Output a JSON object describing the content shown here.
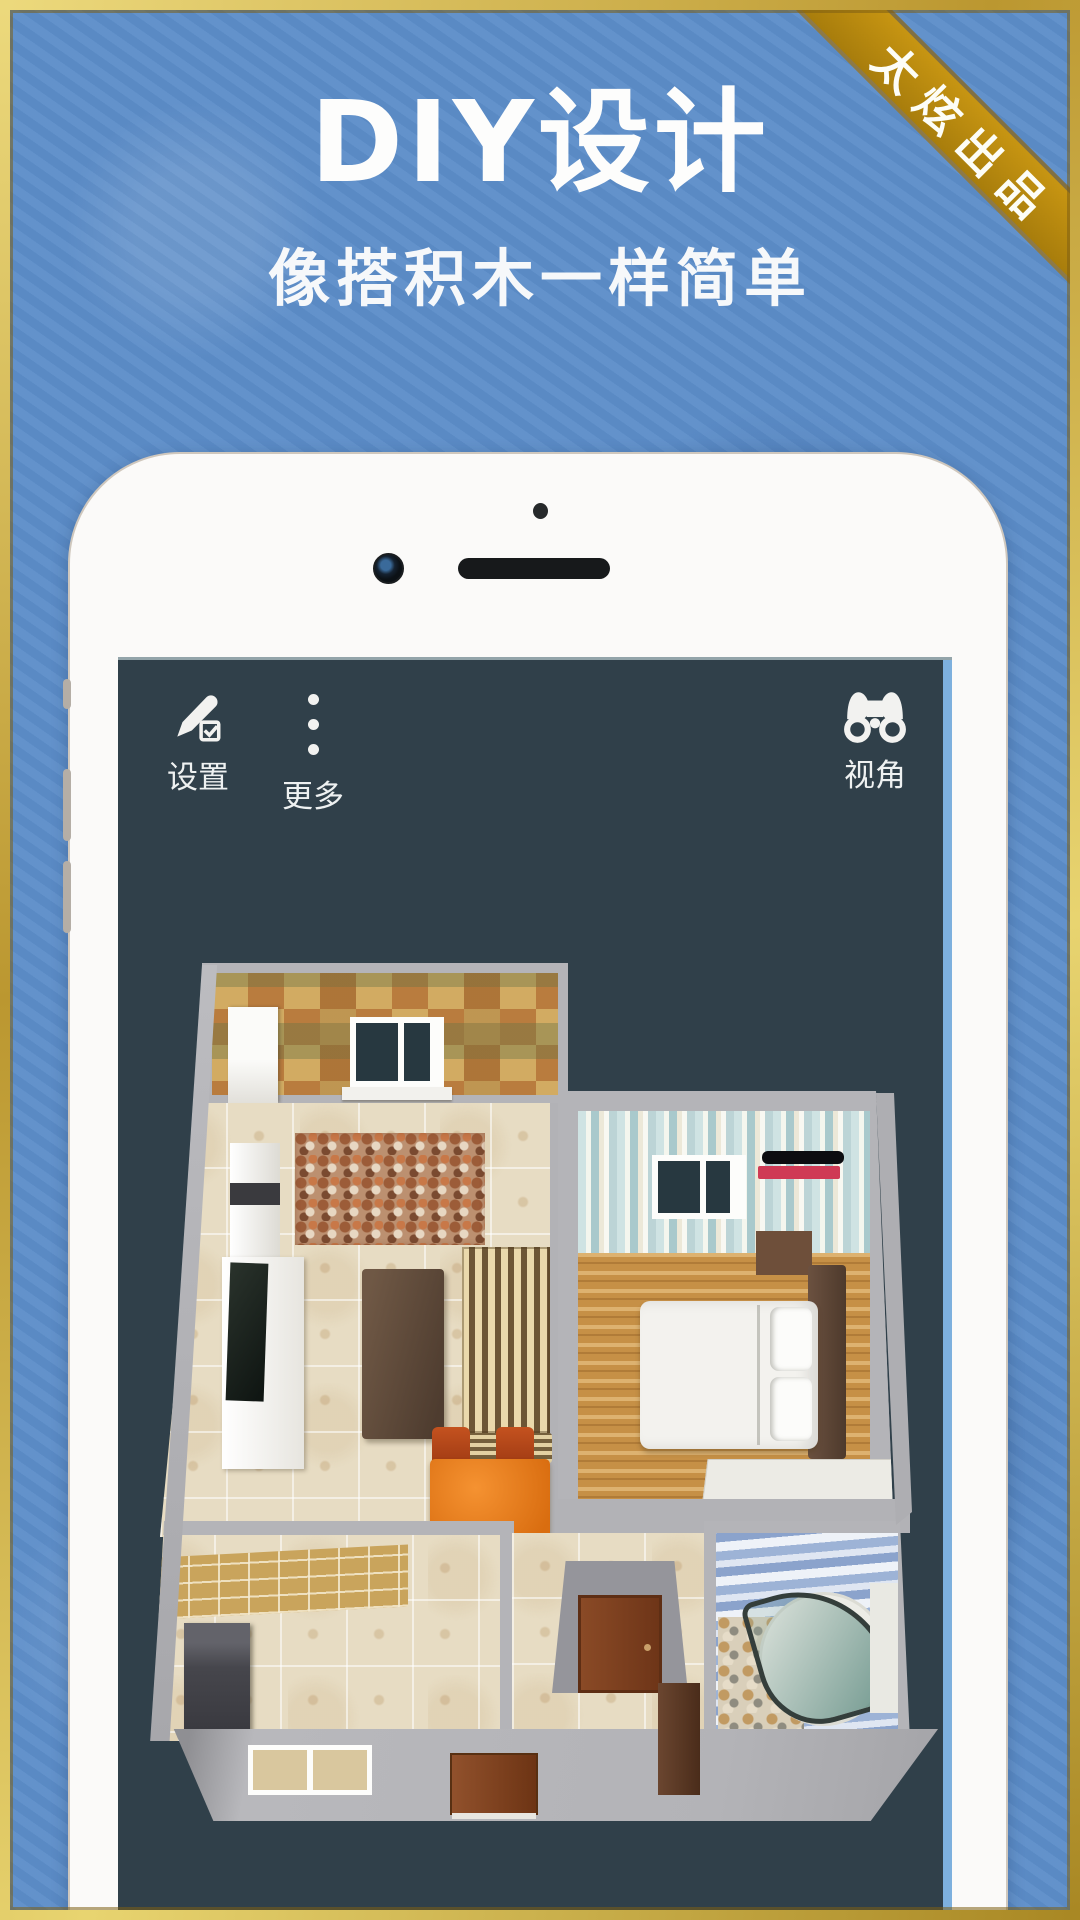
{
  "page": {
    "title": "DIY设计",
    "subtitle": "像搭积木一样简单",
    "ribbon": "太炫出品"
  },
  "toolbar": {
    "items": [
      {
        "id": "settings",
        "label": "设置",
        "icon": "pencil-check-icon"
      },
      {
        "id": "more",
        "label": "更多",
        "icon": "vertical-dots-icon"
      },
      {
        "id": "view",
        "label": "视角",
        "icon": "binoculars-icon"
      }
    ]
  },
  "colors": {
    "background_blue": "#5d8ec9",
    "frame_gold": "#c9a53a",
    "ribbon_gold": "#b9880f",
    "screen_navy": "#30404a",
    "phone_body": "#fbfaf9",
    "wall_gray": "#b4b4b8",
    "floor_beige": "#e7dcc3",
    "wood_floor": "#c69046",
    "table_orange": "#e07818",
    "ac_red": "#cf3a55",
    "shower_teal": "#5c8a80"
  }
}
